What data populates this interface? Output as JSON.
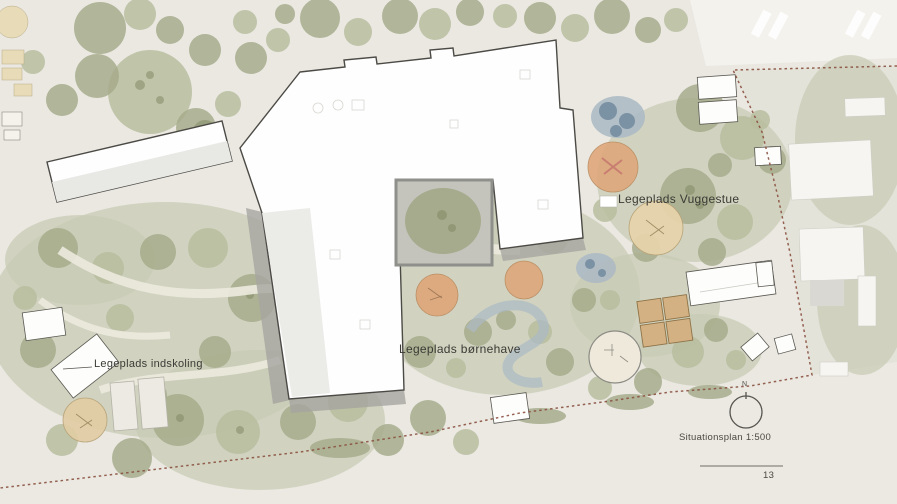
{
  "labels": {
    "playground_vuggestue": "Legeplads Vuggestue",
    "playground_bornehave": "Legeplads børnehave",
    "playground_indskoling": "Legeplads indskoling",
    "scale_caption": "Situationsplan 1:500",
    "north_indicator": "N",
    "page_number": "13"
  },
  "colors": {
    "bg": "#eae8e1",
    "road": "#f3f2ed",
    "road_south": "#ebe9e2",
    "outside": "#e4e3da",
    "green_pale": "#c8cab3",
    "green_light": "#b9bd9f",
    "green_mid": "#a7ac8c",
    "green_dark": "#8f9775",
    "sand": "#e6d3ab",
    "orange": "#dfa77b",
    "deck": "#d4b183",
    "water": "#abb9c4",
    "water_dark": "#7b91a4",
    "building": "#fefefe",
    "outline": "#4c4a45",
    "roof": "#e8e8e5",
    "wall": "#a6a5a0",
    "courtyard": "#c4c4bd",
    "boundary": "#8a5140",
    "ink": "#3b3a35",
    "line": "#6f6d66"
  }
}
